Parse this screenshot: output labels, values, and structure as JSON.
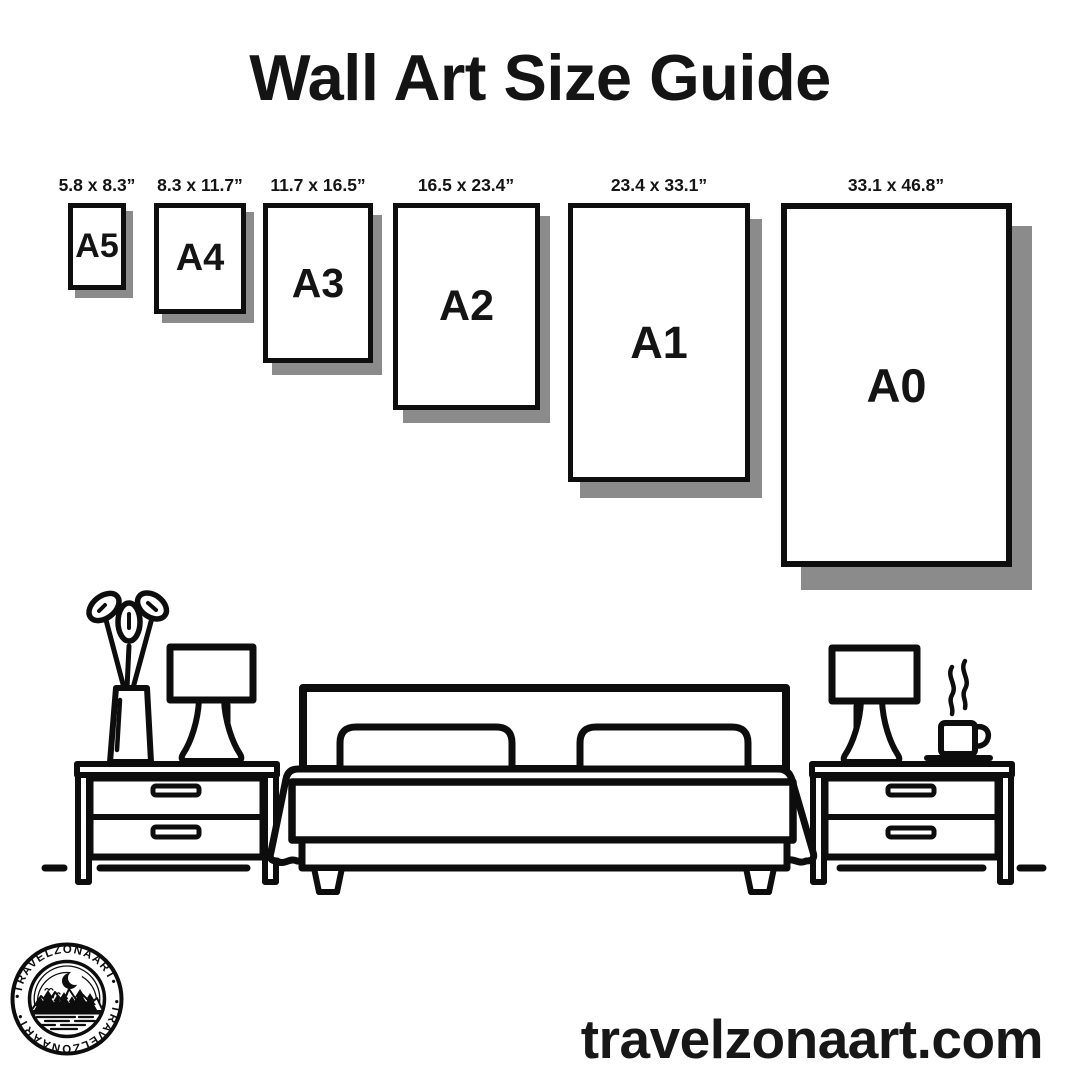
{
  "title": "Wall Art Size Guide",
  "sizes": [
    {
      "label": "A5",
      "dims": "5.8 x 8.3”"
    },
    {
      "label": "A4",
      "dims": "8.3 x 11.7”"
    },
    {
      "label": "A3",
      "dims": "11.7 x 16.5”"
    },
    {
      "label": "A2",
      "dims": "16.5 x 23.4”"
    },
    {
      "label": "A1",
      "dims": "23.4 x 33.1”"
    },
    {
      "label": "A0",
      "dims": "33.1 x 46.8”"
    }
  ],
  "website": "travelzonaart.com",
  "logo": {
    "brand": "TRAVELZONAART",
    "ring_text": "•TRAVELZONAART•"
  },
  "colors": {
    "ink": "#0d0d0d",
    "paper": "#ffffff",
    "shadow": "#8b8b8b"
  },
  "illustration": {
    "icons": [
      "plant-vase-icon",
      "table-lamp-icon",
      "nightstand-icon",
      "bed-icon",
      "pillow-icon",
      "coffee-steam-icon",
      "coffee-cup-icon",
      "moon-icon",
      "birds-icon",
      "mountains-icon",
      "pine-trees-icon",
      "water-icon"
    ]
  }
}
